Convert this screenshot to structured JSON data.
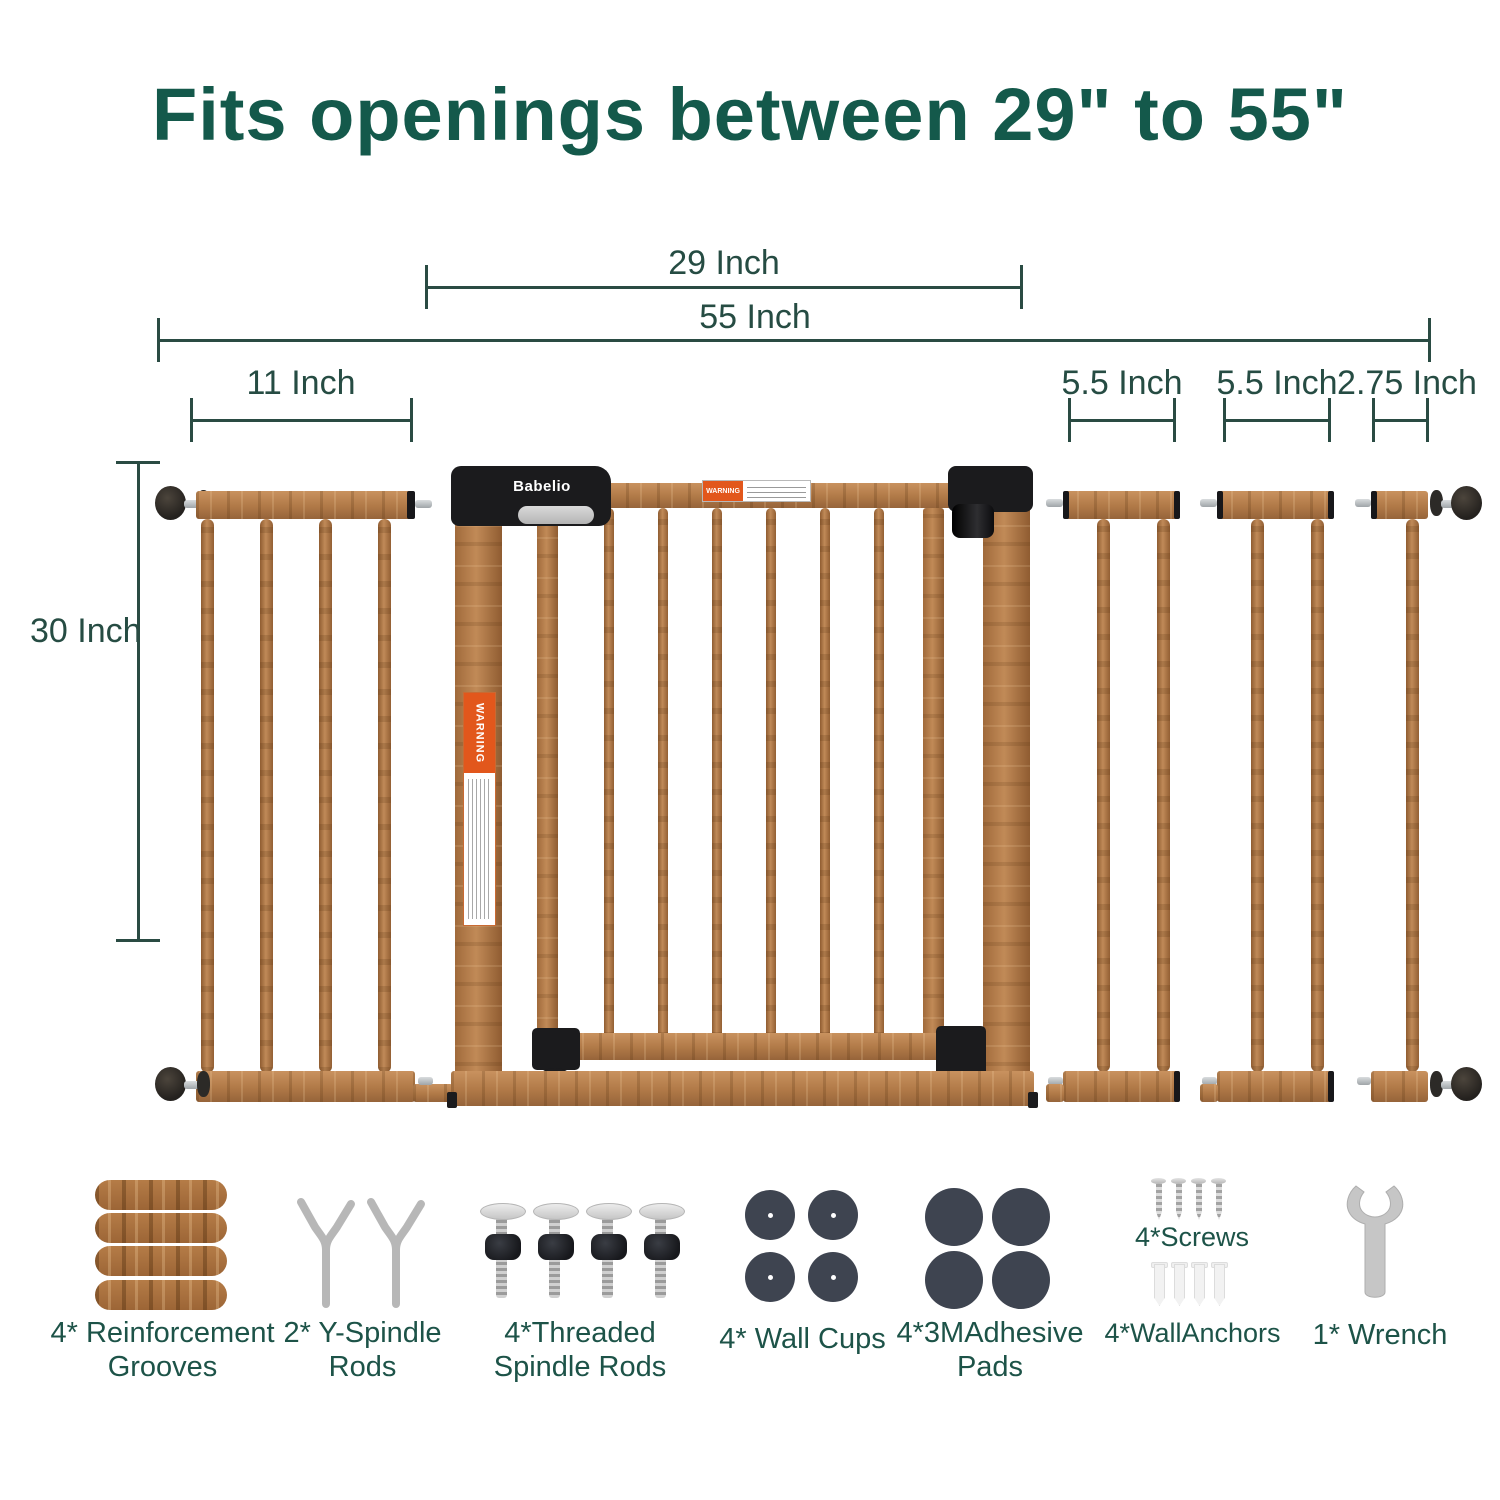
{
  "title": "Fits openings between 29\" to 55\"",
  "dimensions": {
    "gate_width": "29 Inch",
    "max_width": "55 Inch",
    "left_extension": "11 Inch",
    "right_extension_1": "5.5 Inch",
    "right_extension_2": "5.5 Inch",
    "right_extension_3": "2.75 Inch",
    "height": "30 Inch"
  },
  "gate": {
    "brand": "Babelio",
    "warning_label": "WARNING",
    "side_warning_label": "WARNING"
  },
  "accessories": {
    "grooves": {
      "line1": "4* Reinforcement",
      "line2": "Grooves"
    },
    "y_rods": {
      "line1": "2* Y-Spindle",
      "line2": "Rods"
    },
    "threaded_rods": {
      "line1": "4*Threaded",
      "line2": "Spindle Rods"
    },
    "wall_cups": {
      "line1": "4* Wall Cups"
    },
    "adhesive_pads": {
      "line1": "4*3MAdhesive",
      "line2": "Pads"
    },
    "screws": {
      "label": "4*Screws"
    },
    "wall_anchors": {
      "label": "4*WallAnchors"
    },
    "wrench": {
      "label": "1* Wrench"
    }
  },
  "colors": {
    "accent_green": "#14594b",
    "dimension_green": "#2a4b43",
    "wood": "#b8834f",
    "black_plastic": "#1b1b1d",
    "warning_orange": "#e2571c",
    "pad_gray": "#3e4450",
    "metal_silver": "#b9bcbf"
  }
}
